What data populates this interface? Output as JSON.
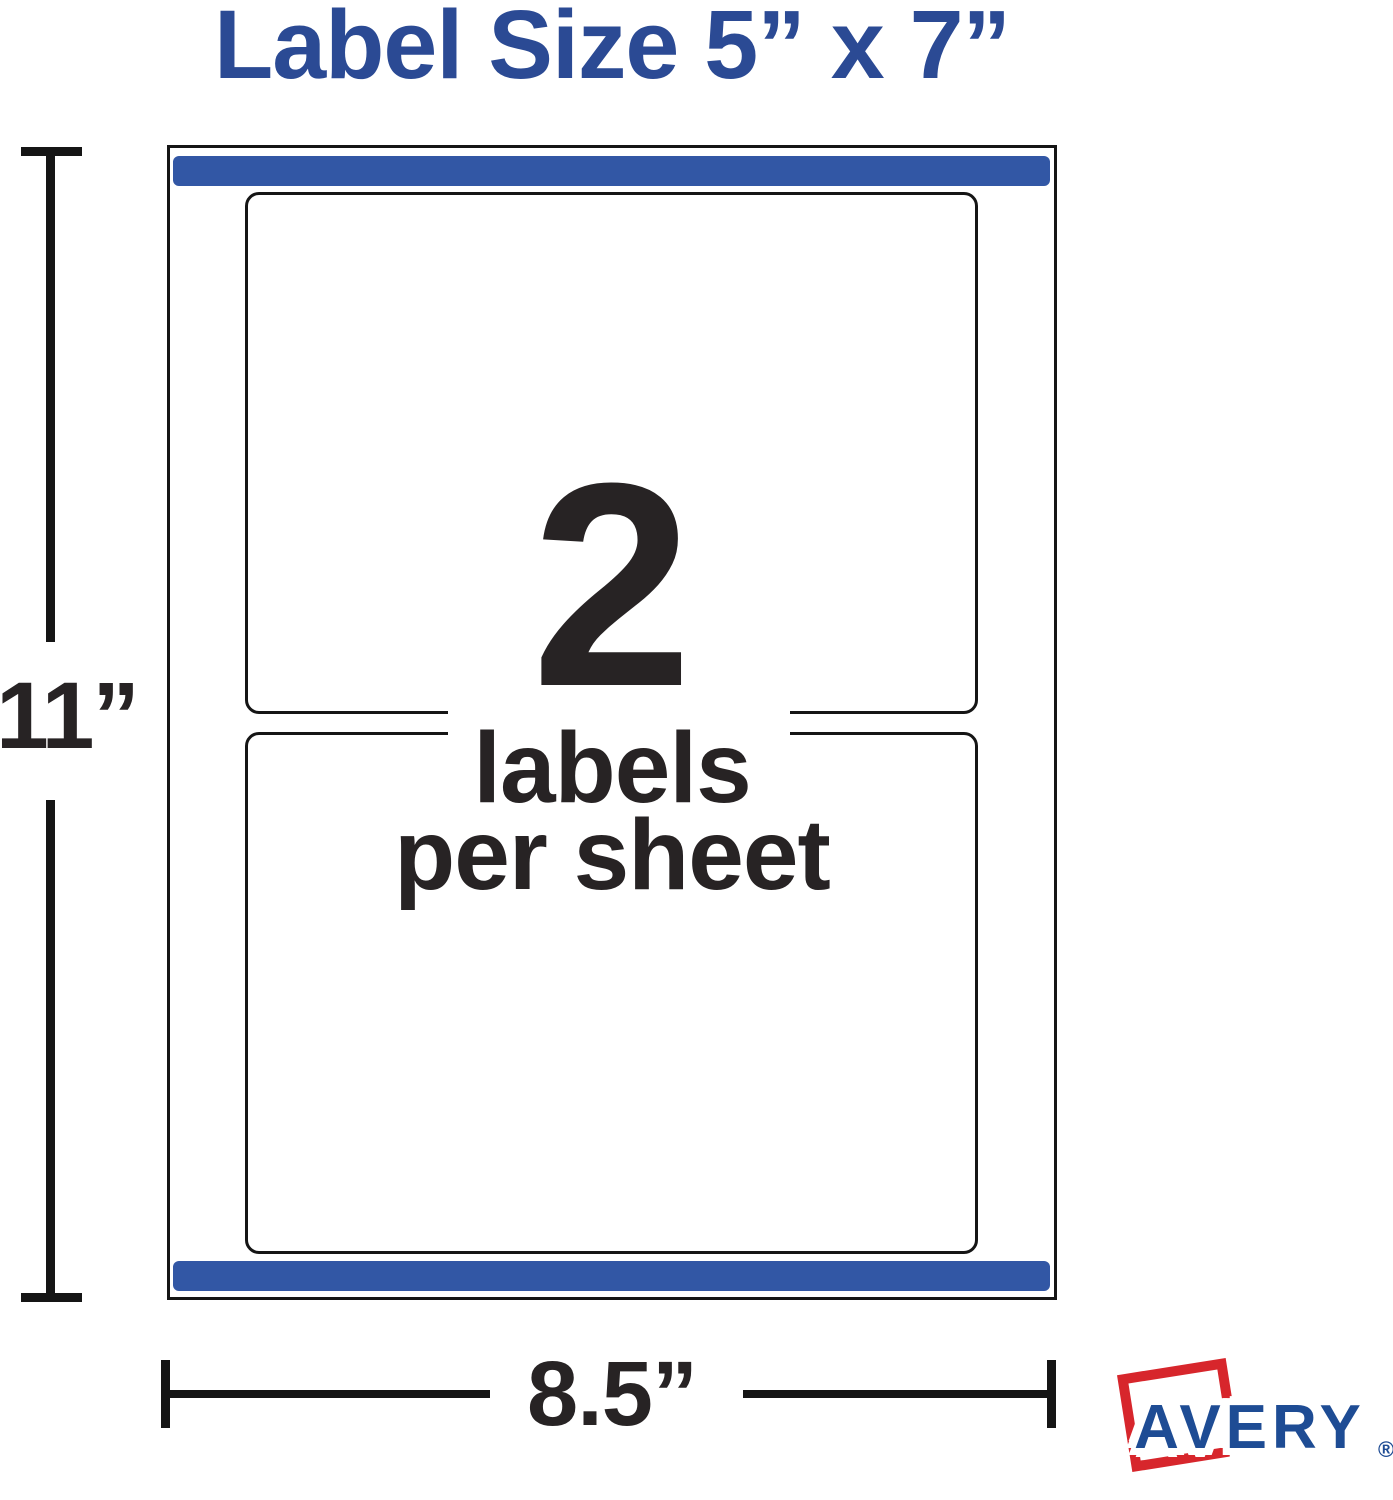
{
  "title": "Label Size 5” x 7”",
  "sheet": {
    "count": "2",
    "caption_line1": "labels",
    "caption_line2": "per sheet"
  },
  "dimensions": {
    "height_label": "11”",
    "width_label": "8.5”"
  },
  "brand": {
    "name": "AVERY",
    "registered_mark": "®"
  },
  "colors": {
    "title_blue": "#2b4a94",
    "strip_blue": "#3257a5",
    "line_black": "#151515",
    "text_black": "#272324",
    "avery_blue": "#1e4c94",
    "avery_red": "#d7262c"
  }
}
